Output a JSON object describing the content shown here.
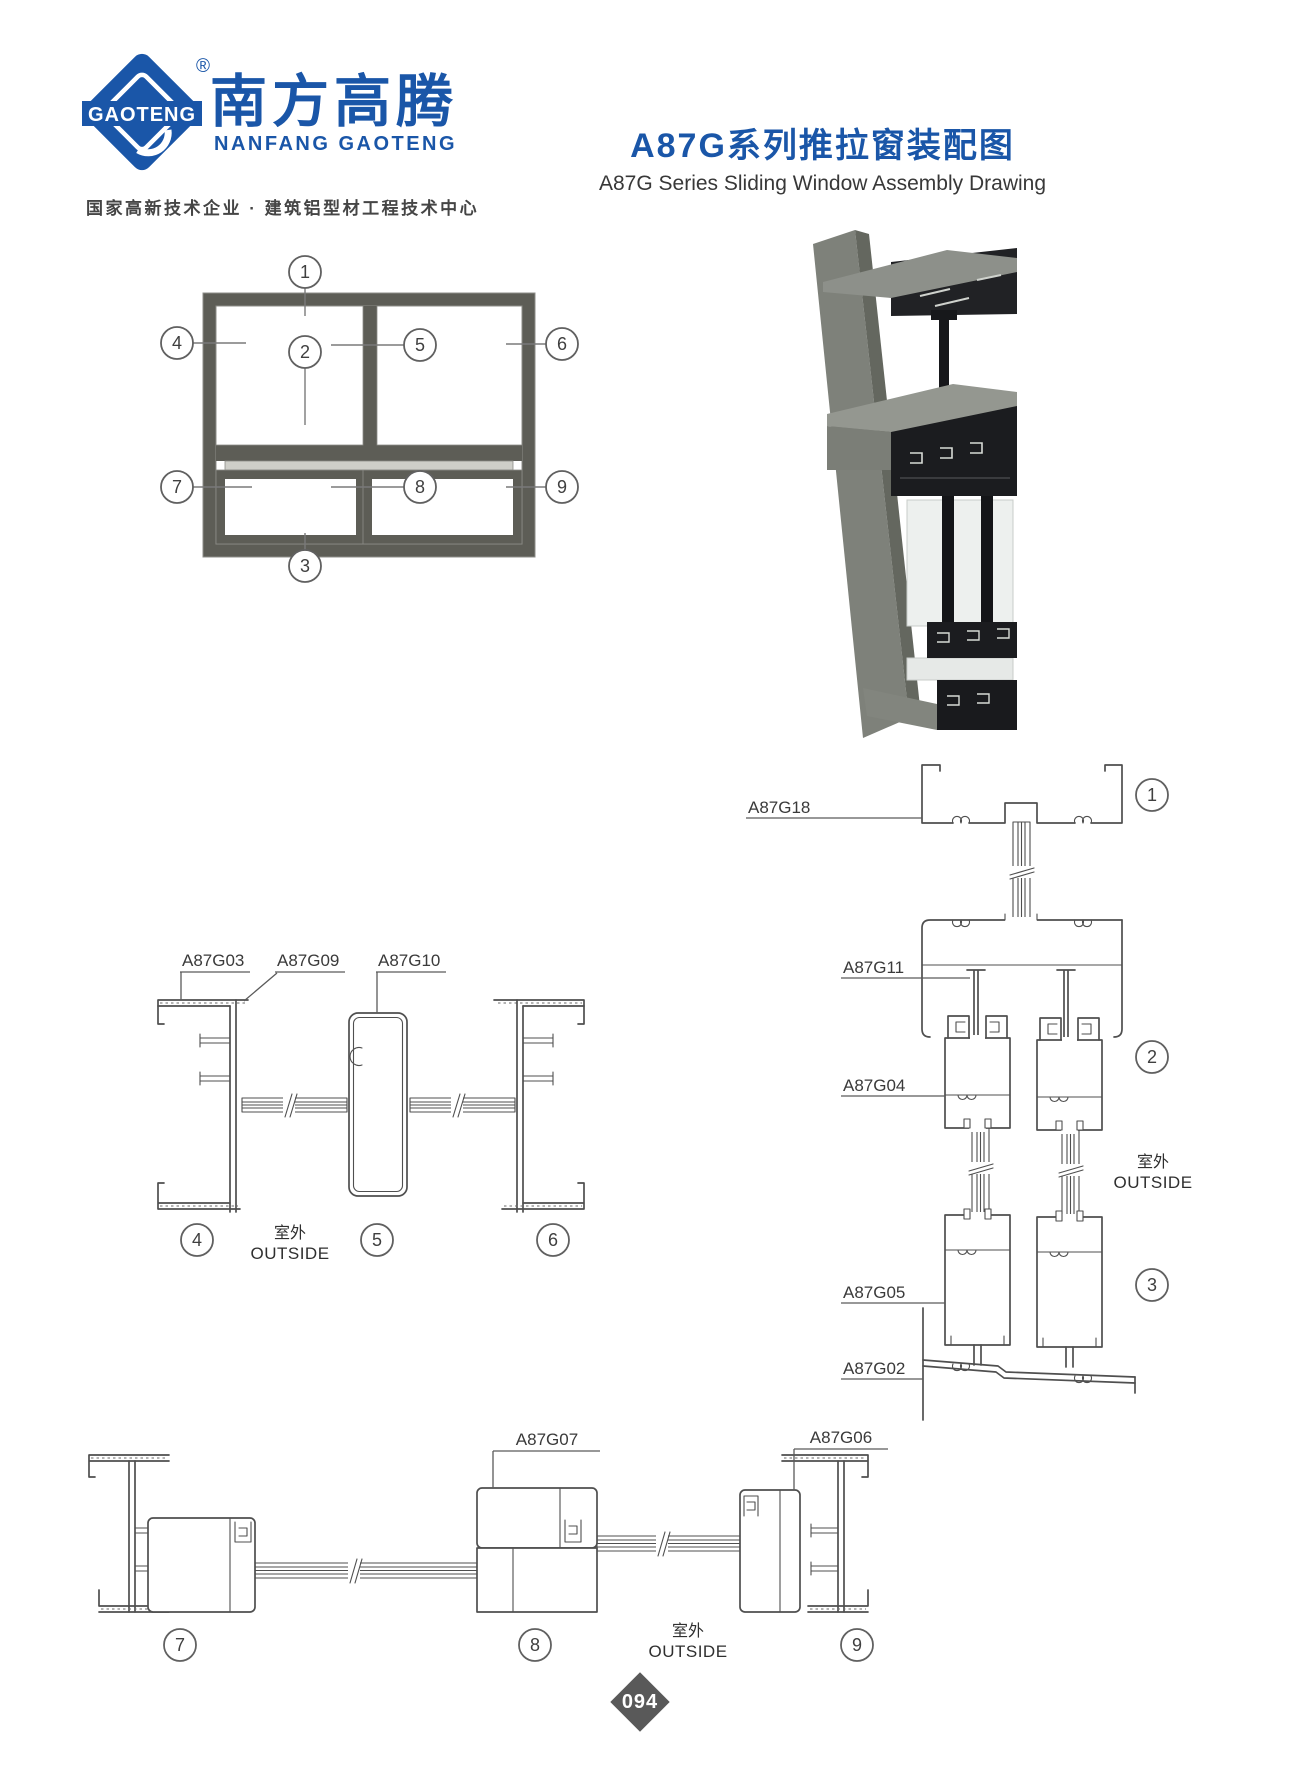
{
  "colors": {
    "brand_blue": "#1a56a8",
    "text_dark": "#383838",
    "line_gray": "#4f4f4f",
    "frame_gray": "#5d5d56",
    "badge_gray": "#595959"
  },
  "header": {
    "logo_text": "GAOTENG",
    "registered": "®",
    "brand_cn": "南方高腾",
    "brand_en": "NANFANG GAOTENG",
    "tagline": "国家高新技术企业 · 建筑铝型材工程技术中心",
    "title_cn": "A87G系列推拉窗装配图",
    "title_en": "A87G Series Sliding Window Assembly Drawing"
  },
  "elevation": {
    "c1": "1",
    "c2": "2",
    "c3": "3",
    "c4": "4",
    "c5": "5",
    "c6": "6",
    "c7": "7",
    "c8": "8",
    "c9": "9"
  },
  "mid": {
    "g03": "A87G03",
    "g09": "A87G09",
    "g10": "A87G10",
    "c4": "4",
    "c5": "5",
    "c6": "6",
    "outside_cn": "室外",
    "outside_en": "OUTSIDE"
  },
  "right": {
    "g18": "A87G18",
    "g11": "A87G11",
    "g04": "A87G04",
    "g05": "A87G05",
    "g02": "A87G02",
    "c1": "1",
    "c2": "2",
    "c3": "3",
    "outside_cn": "室外",
    "outside_en": "OUTSIDE"
  },
  "bottom": {
    "g07": "A87G07",
    "g06": "A87G06",
    "c7": "7",
    "c8": "8",
    "c9": "9",
    "outside_cn": "室外",
    "outside_en": "OUTSIDE"
  },
  "footer": {
    "page_number": "094"
  }
}
